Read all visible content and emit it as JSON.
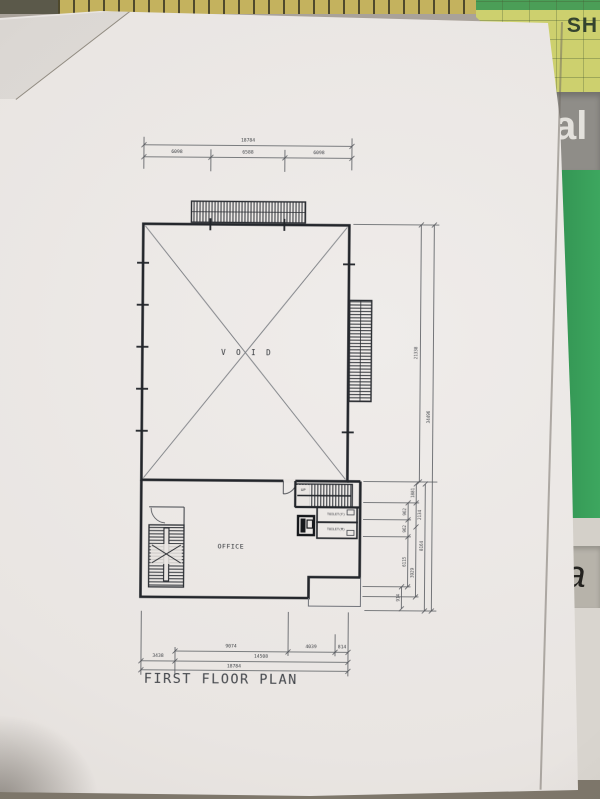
{
  "photo": {
    "surround": {
      "top_right_text": "SH",
      "right_band_upper_text": "al",
      "right_band_lower_text": "ia"
    },
    "colors": {
      "paper": "#e9e5e2",
      "ink": "#3d4045",
      "wall_ink": "#23262b",
      "cutting_mat_green": "#3da75f",
      "ruler_tan": "#c4b25e",
      "folder_yellow": "#cdd06e"
    }
  },
  "plan": {
    "title": "FIRST FLOOR PLAN",
    "labels": {
      "void": "V O I D",
      "office": "OFFICE",
      "stair_direction": "UP",
      "toilet_f": "TOILET(F)",
      "toilet_m": "TOILET(M)"
    },
    "dimensions": {
      "top": {
        "total": "18784",
        "segments": [
          "6098",
          "6588",
          "6098"
        ]
      },
      "bottom": {
        "upper_segments": [
          "9074",
          "4039",
          "814"
        ],
        "mid_segments": [
          "3438",
          "14508"
        ],
        "total": "18784"
      },
      "right": {
        "void_height": "21338",
        "total_height": "34496",
        "detail": [
          "1881",
          "962",
          "2134",
          "962",
          "8164",
          "6115",
          "3929",
          "914"
        ]
      }
    }
  }
}
